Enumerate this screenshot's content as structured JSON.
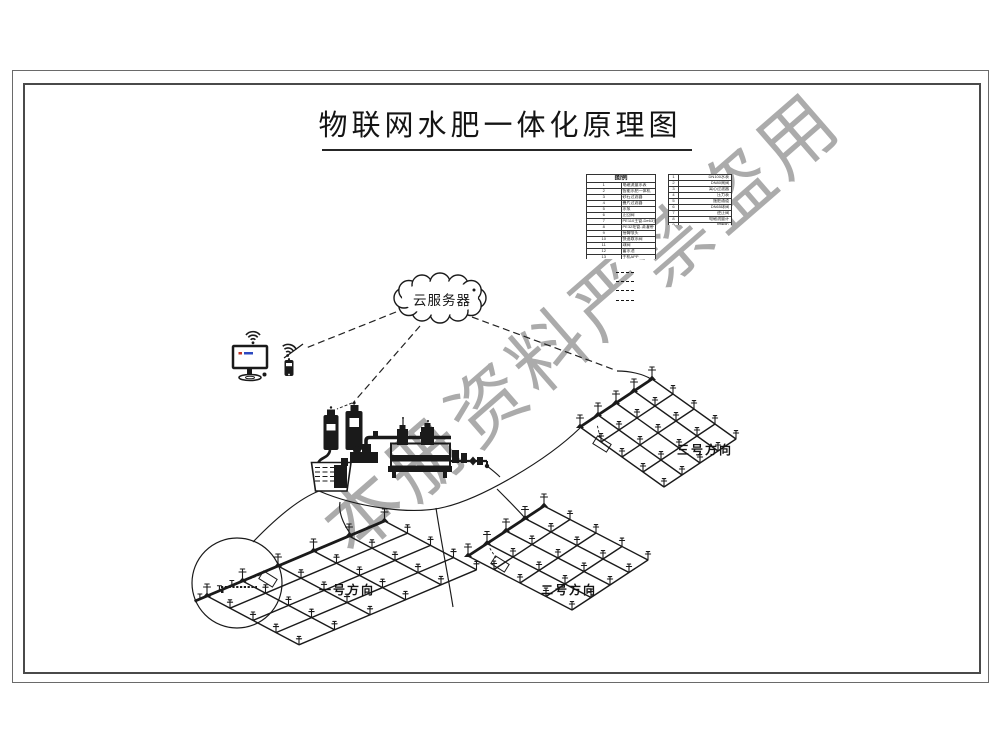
{
  "page": {
    "title": "物联网水肥一体化原理图"
  },
  "watermark": {
    "text": "本册资料严禁盗用",
    "color": "#979797"
  },
  "cloud": {
    "label": "云服务器"
  },
  "legend": {
    "title": "图例",
    "items": [
      {
        "no": "1",
        "label": "电磁流量水表"
      },
      {
        "no": "2",
        "label": "智能水肥一体机"
      },
      {
        "no": "3",
        "label": "砂石过滤器"
      },
      {
        "no": "4",
        "label": "叠片过滤器"
      },
      {
        "no": "5",
        "label": "水泵"
      },
      {
        "no": "6",
        "label": "止回阀"
      },
      {
        "no": "7",
        "label": "PE110主管-De63支管"
      },
      {
        "no": "8",
        "label": "PE32毛管-滴灌带"
      },
      {
        "no": "9",
        "label": "摇臂喷头"
      },
      {
        "no": "10",
        "label": "快速取水阀"
      },
      {
        "no": "11",
        "label": "球阀"
      },
      {
        "no": "12",
        "label": "蓄水池"
      },
      {
        "no": "13",
        "label": "手机APP"
      },
      {
        "no": "14",
        "label": "云服务器"
      }
    ],
    "spec_items": [
      {
        "no": "1",
        "value": "DN100水表"
      },
      {
        "no": "2",
        "value": "DN80闸阀"
      },
      {
        "no": "3",
        "value": "离心过滤器"
      },
      {
        "no": "4",
        "value": "压力表"
      },
      {
        "no": "5",
        "value": "施肥通道"
      },
      {
        "no": "6",
        "value": "DN65球阀"
      },
      {
        "no": "7",
        "value": "逆止阀"
      },
      {
        "no": "8",
        "value": "电磁流量计"
      },
      {
        "no": "9",
        "value": "控制柜"
      }
    ],
    "line_samples": [
      {
        "style": "dashed"
      },
      {
        "style": "dashed"
      },
      {
        "style": "dashed"
      },
      {
        "style": "dashed"
      }
    ]
  },
  "fields": [
    {
      "label": "一号方向"
    },
    {
      "label": "二号方向"
    },
    {
      "label": "三号方向"
    }
  ],
  "icons": {
    "wifi": "wifi-icon",
    "cloud": "cloud-server-shape",
    "monitor": "desktop-monitor-icon",
    "phone": "smartphone-icon",
    "sprinkler": "sprinkler-glyph"
  },
  "colors": {
    "ink": "#1a1a1a",
    "watermark": "#979797",
    "screen_red": "#c03325",
    "screen_blue": "#2c49c0"
  }
}
